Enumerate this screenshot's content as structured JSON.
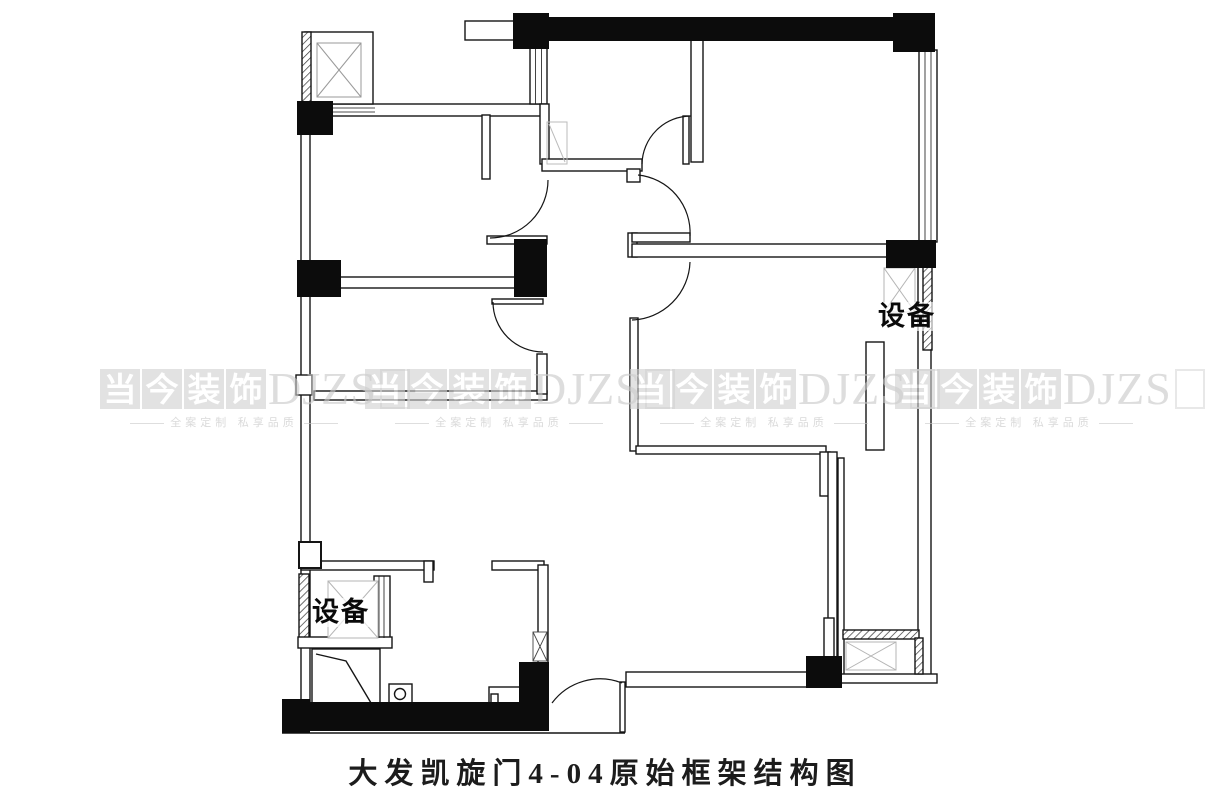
{
  "title": "大发凯旋门4-04原始框架结构图",
  "equipment_labels": {
    "right": "设备",
    "left": "设备"
  },
  "watermark": {
    "chars": [
      "当",
      "今",
      "装",
      "饰"
    ],
    "latin": "DJZS",
    "tagline": "全案定制 私享品质"
  },
  "colors": {
    "line": "#151515",
    "column_fill": "#0c0c0c",
    "watermark_gray": "#cfcfcf",
    "background": "#ffffff"
  }
}
